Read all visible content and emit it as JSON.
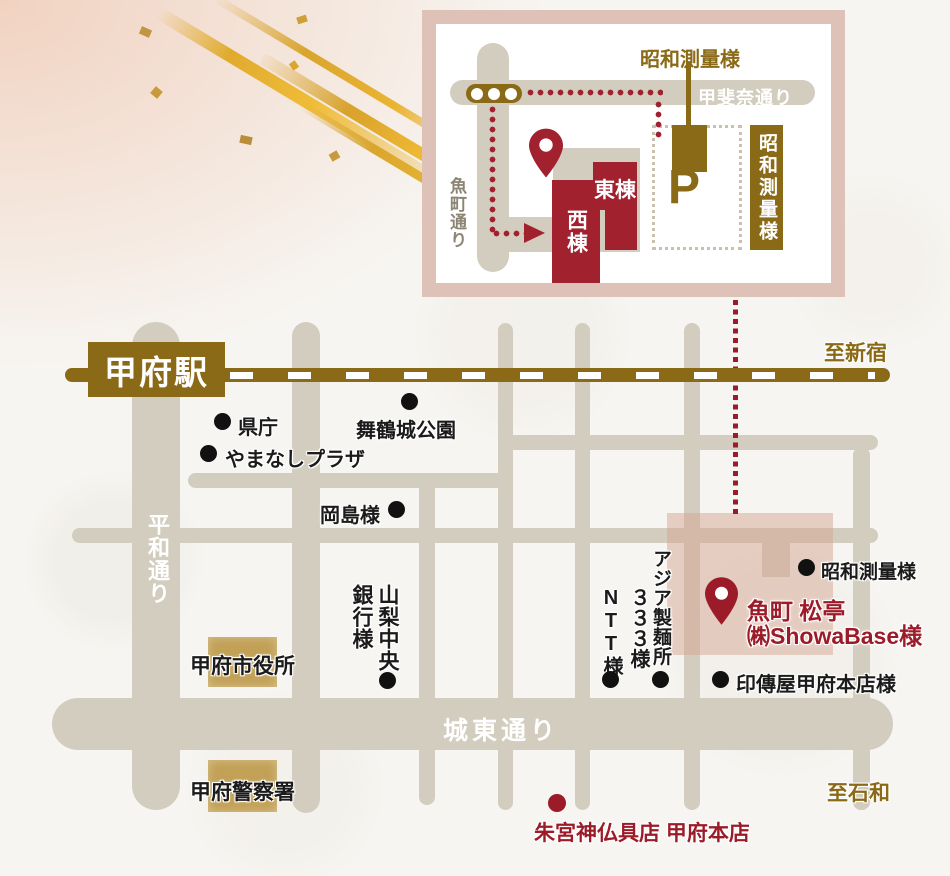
{
  "colors": {
    "gold": "#8a6a16",
    "road_beige": "#d3cdbf",
    "building_red": "#a1212f",
    "accent_dark_red": "#9c1b29",
    "tan_block": "#c2a156",
    "pink_frame": "#dec1b7",
    "pink_highlight": "rgba(213,165,145,0.5)"
  },
  "inset": {
    "showa_label_top": "昭和測量様",
    "kaina_street": "甲斐奈通り",
    "uomachi_street": "魚町通り",
    "west_building": "西棟",
    "east_building": "東棟",
    "parking_mark": "P",
    "showa_block_label": "昭和測量様"
  },
  "map": {
    "station_label": "甲府駅",
    "dir_shinjuku": "至新宿",
    "dir_isawa": "至石和",
    "heiwa_street": "平和通り",
    "joto_street": "城東通り",
    "poi": {
      "kencho": "県庁",
      "maizuru_park": "舞鶴城公園",
      "yamanashi_plaza": "やまなしプラザ",
      "okajima": "岡島様",
      "city_hall": "甲府市役所",
      "police": "甲府警察署",
      "bank_col_right": "山梨中央",
      "bank_col_left": "銀行様",
      "ntt": "NTT様",
      "asia_col_right": "アジア製麺所",
      "asia_col_left": "３３３様",
      "inden": "印傳屋甲府本店様",
      "showa_survey": "昭和測量様",
      "shumiya": "朱宮神仏具店 甲府本店"
    },
    "destination": {
      "line1": "魚町 松亭",
      "line2": "㈱ShowaBase様"
    }
  }
}
